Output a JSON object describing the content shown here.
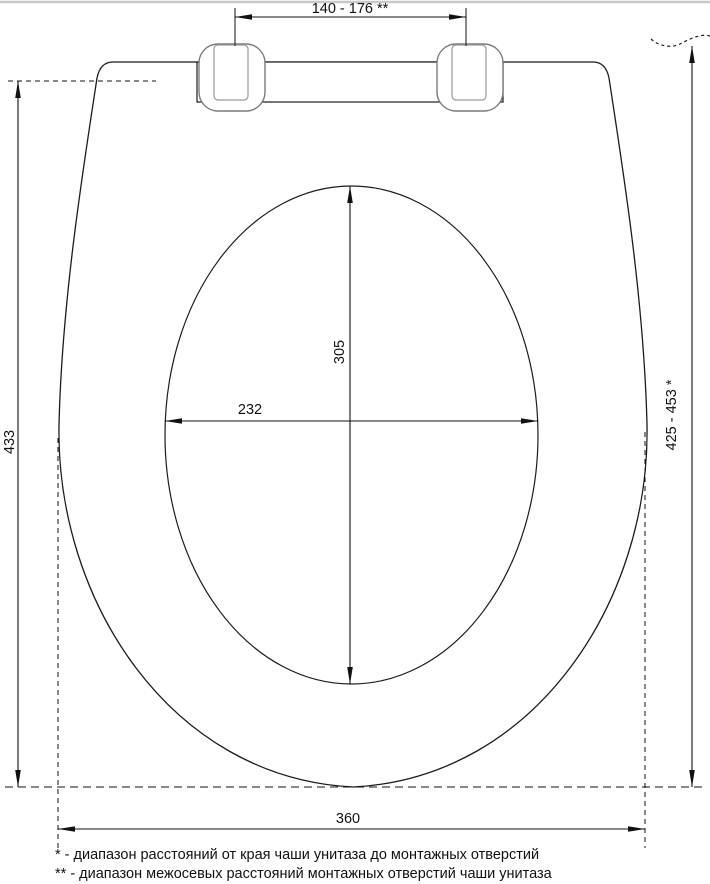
{
  "drawing": {
    "labels": {
      "hinge_hole_spacing": "140 - 176 **",
      "seat_length": "433",
      "mount_hole_range": "425 - 453 *",
      "opening_length": "305",
      "opening_width": "232",
      "seat_width": "360"
    },
    "footnotes": {
      "first": "* - диапазон расстояний от края чаши унитаза до монтажных отверстий",
      "second": "** - диапазон межосевых расстояний монтажных отверстий чаши унитаза"
    },
    "colors": {
      "line": "#1c1c1c",
      "hinge_line": "#7a7a7a",
      "background": "#ffffff",
      "top_border": "#c8c8c8"
    }
  }
}
